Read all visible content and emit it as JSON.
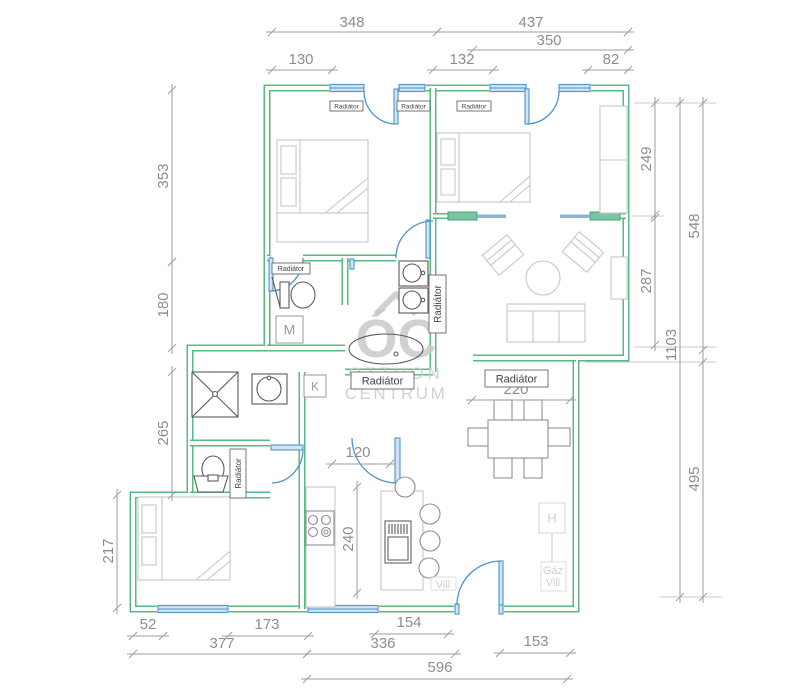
{
  "colors": {
    "wall_green": "#58b981",
    "window_blue": "#4f93c9",
    "window_fill": "#cfe4f6",
    "sliding_panel_teal": "#7cc6a6",
    "furniture_gray": "#c6c6c6",
    "furniture_dark_gray": "#8f8f8f",
    "sanitary_gray": "#5a5a5a",
    "dimension_gray": "#9e9e9e",
    "dimension_text_gray": "#8d8d8d",
    "utility_light_gray": "#cfcfcf",
    "watermark_gray": "#c9c9c9",
    "background": "#ffffff"
  },
  "watermark": {
    "initials": "ÓC",
    "line1": "OTTHON",
    "line2": "CENTRUM"
  },
  "radiator_label": "Radiátor",
  "radiators": [
    {
      "x": 330,
      "y": 101,
      "w": 33,
      "h": 10,
      "fs": 6.5
    },
    {
      "x": 397,
      "y": 101,
      "w": 33,
      "h": 10,
      "fs": 6.5
    },
    {
      "x": 457,
      "y": 101,
      "w": 34,
      "h": 10,
      "fs": 6.5
    },
    {
      "x": 272,
      "y": 263,
      "w": 38,
      "h": 11,
      "fs": 7
    },
    {
      "x": 351,
      "y": 372,
      "w": 63,
      "h": 17,
      "fs": 11
    },
    {
      "x": 485,
      "y": 370,
      "w": 63,
      "h": 17,
      "fs": 11
    },
    {
      "x": 429,
      "y": 275,
      "w": 17,
      "h": 58,
      "fs": 10,
      "rot": 1
    },
    {
      "x": 230,
      "y": 449,
      "w": 16,
      "h": 49,
      "fs": 8,
      "rot": 1
    }
  ],
  "markers": [
    {
      "text": "M",
      "x": 276,
      "y": 316,
      "w": 27,
      "h": 27,
      "fs": 14
    },
    {
      "text": "K",
      "x": 304,
      "y": 375,
      "w": 22,
      "h": 22,
      "fs": 12
    },
    {
      "text": "H",
      "x": 539,
      "y": 503,
      "w": 26,
      "h": 30,
      "fs": 13,
      "light": true
    }
  ],
  "utilities": [
    {
      "text": "Gáz",
      "x": 553,
      "y": 574,
      "fs": 11
    },
    {
      "text": "Vill",
      "x": 553,
      "y": 586,
      "fs": 11
    },
    {
      "text": "Vill",
      "x": 443,
      "y": 588,
      "fs": 11
    }
  ],
  "dimensions": [
    {
      "value": "348",
      "x1": 272,
      "y1": 32,
      "x2": 437,
      "y2": 32,
      "lx": 352,
      "ly": 27
    },
    {
      "value": "437",
      "x1": 437,
      "y1": 32,
      "x2": 628,
      "y2": 32,
      "lx": 531,
      "ly": 27
    },
    {
      "value": "350",
      "x1": 473,
      "y1": 50,
      "x2": 628,
      "y2": 50,
      "lx": 549,
      "ly": 45
    },
    {
      "value": "130",
      "x1": 272,
      "y1": 70,
      "x2": 332,
      "y2": 70,
      "lx": 301,
      "ly": 64
    },
    {
      "value": "132",
      "x1": 433,
      "y1": 70,
      "x2": 493,
      "y2": 70,
      "lx": 462,
      "ly": 64
    },
    {
      "value": "82",
      "x1": 588,
      "y1": 70,
      "x2": 628,
      "y2": 70,
      "lx": 611,
      "ly": 64
    },
    {
      "value": "353",
      "x1": 172,
      "y1": 90,
      "x2": 172,
      "y2": 262,
      "lx": 168,
      "ly": 176,
      "rot": 1
    },
    {
      "value": "180",
      "x1": 172,
      "y1": 262,
      "x2": 172,
      "y2": 348,
      "lx": 168,
      "ly": 305,
      "rot": 1
    },
    {
      "value": "265",
      "x1": 172,
      "y1": 372,
      "x2": 172,
      "y2": 495,
      "lx": 168,
      "ly": 433,
      "rot": 1
    },
    {
      "value": "217",
      "x1": 117,
      "y1": 495,
      "x2": 117,
      "y2": 608,
      "lx": 113,
      "ly": 551,
      "rot": 1
    },
    {
      "value": "249",
      "x1": 655,
      "y1": 103,
      "x2": 655,
      "y2": 215,
      "lx": 651,
      "ly": 159,
      "rot": 1
    },
    {
      "value": "287",
      "x1": 655,
      "y1": 218,
      "x2": 655,
      "y2": 345,
      "lx": 651,
      "ly": 281,
      "rot": 1
    },
    {
      "value": "548",
      "x1": 703,
      "y1": 103,
      "x2": 703,
      "y2": 350,
      "lx": 699,
      "ly": 226,
      "rot": 1
    },
    {
      "value": "1103",
      "x1": 680,
      "y1": 103,
      "x2": 680,
      "y2": 597,
      "lx": 676,
      "ly": 345,
      "rot": 1
    },
    {
      "value": "495",
      "x1": 703,
      "y1": 362,
      "x2": 703,
      "y2": 597,
      "lx": 699,
      "ly": 479,
      "rot": 1
    },
    {
      "value": "52",
      "x1": 133,
      "y1": 636,
      "x2": 163,
      "y2": 636,
      "lx": 148,
      "ly": 629
    },
    {
      "value": "173",
      "x1": 228,
      "y1": 636,
      "x2": 308,
      "y2": 636,
      "lx": 267,
      "ly": 629
    },
    {
      "value": "154",
      "x1": 375,
      "y1": 634,
      "x2": 448,
      "y2": 634,
      "lx": 409,
      "ly": 627
    },
    {
      "value": "377",
      "x1": 133,
      "y1": 654,
      "x2": 307,
      "y2": 654,
      "lx": 222,
      "ly": 648
    },
    {
      "value": "336",
      "x1": 307,
      "y1": 654,
      "x2": 455,
      "y2": 654,
      "lx": 383,
      "ly": 648
    },
    {
      "value": "153",
      "x1": 500,
      "y1": 653,
      "x2": 570,
      "y2": 653,
      "lx": 536,
      "ly": 646
    },
    {
      "value": "596",
      "x1": 307,
      "y1": 679,
      "x2": 567,
      "y2": 679,
      "lx": 440,
      "ly": 672
    },
    {
      "value": "220",
      "x1": 472,
      "y1": 400,
      "x2": 570,
      "y2": 400,
      "lx": 516,
      "ly": 394
    },
    {
      "value": "120",
      "x1": 332,
      "y1": 464,
      "x2": 390,
      "y2": 464,
      "lx": 358,
      "ly": 457
    },
    {
      "value": "240",
      "x1": 357,
      "y1": 487,
      "x2": 357,
      "y2": 593,
      "lx": 353,
      "ly": 539,
      "rot": 1
    }
  ]
}
